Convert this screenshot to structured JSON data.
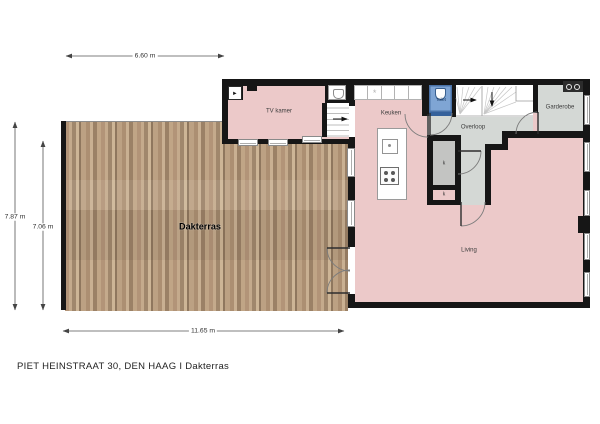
{
  "footer": {
    "text": "PIET HEINSTRAAT 30, DEN HAAG  I  Dakterras"
  },
  "dimensions": {
    "top": "6.60 m",
    "left_outer": "7.87 m",
    "left_inner": "7.06 m",
    "bottom": "11.65 m"
  },
  "rooms": {
    "tv_kamer": "TV kamer",
    "keuken": "Keuken",
    "toilet": "Toilet",
    "overloop": "Overloop",
    "garderobe": "Garderobe",
    "living": "Living",
    "dakterras": "Dakterras",
    "closet": "k"
  },
  "icons": {
    "tv_glyph": "▶",
    "hob_glyph": "*"
  },
  "colors": {
    "room_fill": "#ecc9c9",
    "hall_fill": "#d4d8d5",
    "closet_fill": "#c3c4c2",
    "toilet_fill": "#7fa5d4",
    "toilet_border": "#35619b",
    "wall": "#161616",
    "wood_base": "#b29478"
  }
}
